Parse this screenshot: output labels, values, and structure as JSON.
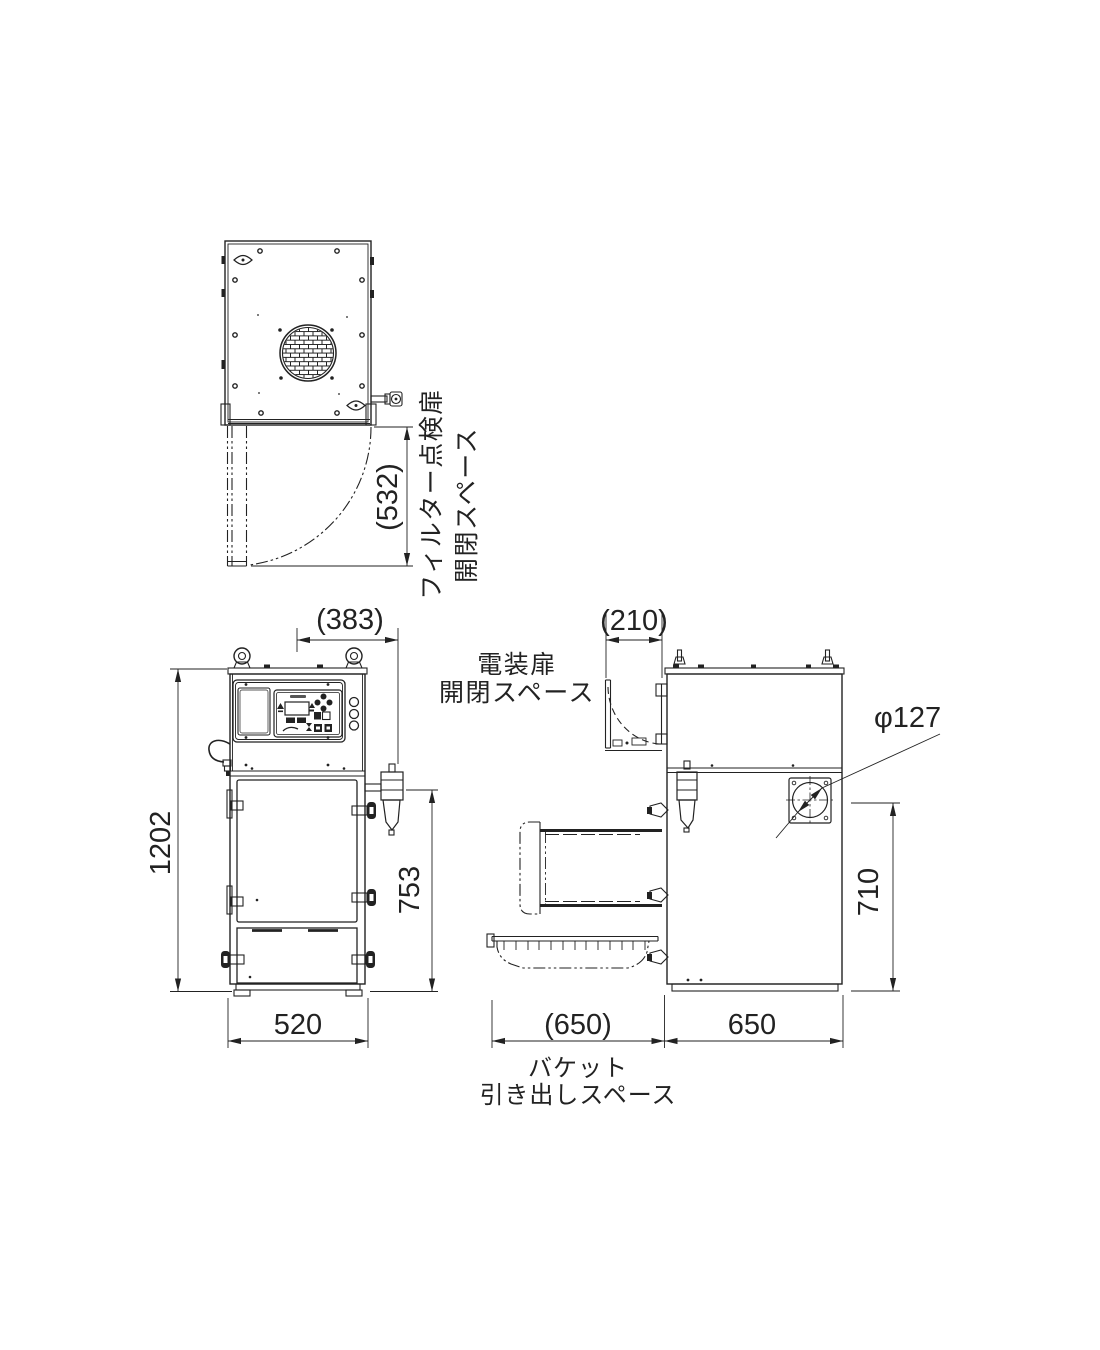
{
  "drawing": {
    "dims": {
      "top_door_space": "(532)",
      "front_offset": "(383)",
      "front_height": "1202",
      "front_mid_height": "753",
      "front_width": "520",
      "side_door_space": "(210)",
      "side_height": "710",
      "side_pullout": "(650)",
      "side_depth": "650",
      "port_diameter": "φ127"
    },
    "labels": {
      "filter_door_l1": "フィルター点検扉",
      "filter_door_l2": "開閉スペース",
      "electrical_l1": "電装扉",
      "electrical_l2": "開閉スペース",
      "bucket_l1": "バケット",
      "bucket_l2": "引き出しスペース"
    },
    "colors": {
      "line": "#222222",
      "background": "#ffffff"
    }
  }
}
